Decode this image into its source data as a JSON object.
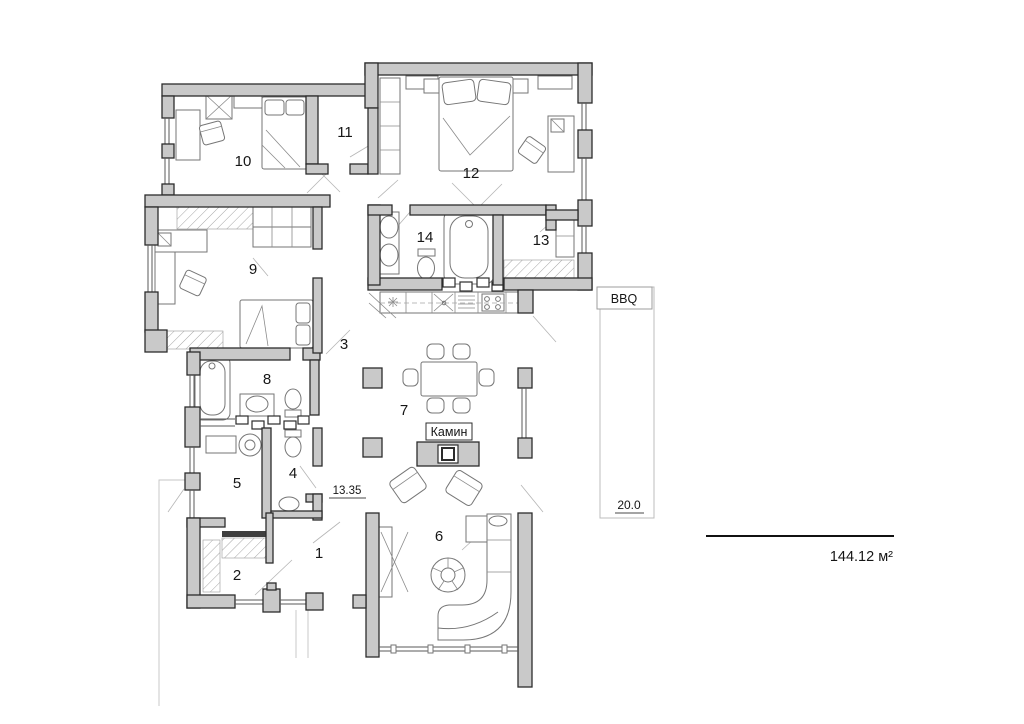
{
  "colors": {
    "wall_fill": "#c9c9c9",
    "wall_stroke": "#2c2c2c",
    "furniture_stroke": "#767676",
    "leader": "#b5b5b5",
    "text": "#161616"
  },
  "rooms": [
    {
      "number": "1"
    },
    {
      "number": "2"
    },
    {
      "number": "3"
    },
    {
      "number": "4"
    },
    {
      "number": "5"
    },
    {
      "number": "6"
    },
    {
      "number": "7"
    },
    {
      "number": "8"
    },
    {
      "number": "9"
    },
    {
      "number": "10"
    },
    {
      "number": "11"
    },
    {
      "number": "12"
    },
    {
      "number": "13"
    },
    {
      "number": "14"
    }
  ],
  "labels": {
    "fireplace": "Камин",
    "bbq": "BBQ",
    "dim_width": "13.35",
    "dim_terrace_height": "20.0",
    "total_area": "144.12 м²"
  }
}
